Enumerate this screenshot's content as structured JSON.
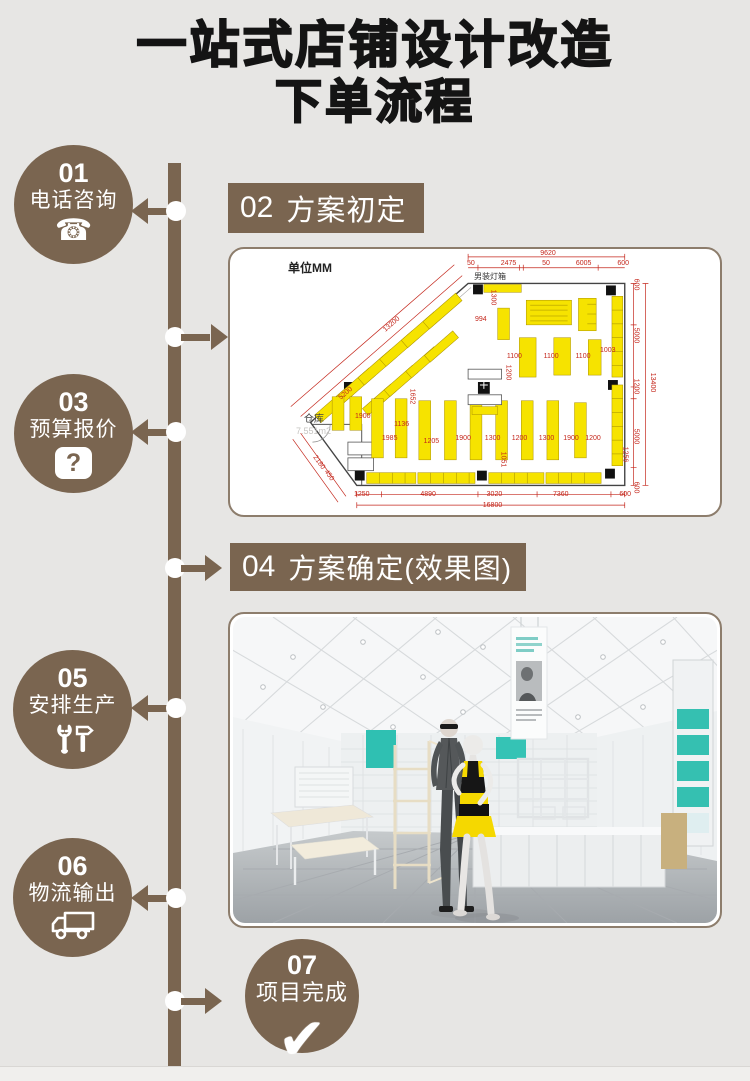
{
  "page": {
    "background": "#e7e6e4",
    "accent_brown": "#7a6550",
    "dim_red": "#c4271c",
    "shelf_yellow": "#f6e300",
    "teal": "#2fc0b2"
  },
  "title": {
    "line1": "一站式店铺设计改造",
    "line2": "下单流程"
  },
  "steps": {
    "s01": {
      "num": "01",
      "label": "电话咨询",
      "icon": "phone-icon",
      "icon_char": "☎"
    },
    "s02": {
      "num": "02",
      "label": "方案初定"
    },
    "s03": {
      "num": "03",
      "label": "预算报价",
      "icon": "question-icon",
      "icon_char": "?"
    },
    "s04": {
      "num": "04",
      "label": "方案确定(效果图)"
    },
    "s05": {
      "num": "05",
      "label": "安排生产",
      "icon": "tools-icon"
    },
    "s06": {
      "num": "06",
      "label": "物流输出",
      "icon": "truck-icon"
    },
    "s07": {
      "num": "07",
      "label": "项目完成",
      "icon": "check-icon",
      "icon_char": "✔"
    }
  },
  "floorplan": {
    "unit_label": "单位MM",
    "warehouse_label": "仓库",
    "warehouse_area": "7.551m2",
    "lightbox_label": "男装灯箱",
    "dims_top_total": "9620",
    "dims_top": [
      "50",
      "2475",
      "50",
      "6005",
      "600"
    ],
    "dims_right": [
      "600",
      "5000",
      "1200",
      "5000",
      "600"
    ],
    "dims_right_total": "13400",
    "dims_bottom": [
      "1250",
      "4890",
      "3020",
      "7360",
      "600"
    ],
    "dims_bottom_total": "16800",
    "dims_diag": [
      {
        "t": "13200",
        "x": 31,
        "y": 27,
        "r": -41
      },
      {
        "t": "5200",
        "x": 22,
        "y": 53,
        "r": -41
      },
      {
        "t": "2180",
        "x": 16.5,
        "y": 79,
        "r": 54
      },
      {
        "t": "450",
        "x": 19,
        "y": 84,
        "r": 54
      }
    ],
    "shelf_labels": [
      {
        "t": "1300",
        "x": 52,
        "y": 17,
        "r": 90
      },
      {
        "t": "994",
        "x": 50,
        "y": 25
      },
      {
        "t": "1100",
        "x": 56.5,
        "y": 39
      },
      {
        "t": "1100",
        "x": 64,
        "y": 39
      },
      {
        "t": "1100",
        "x": 70.5,
        "y": 39
      },
      {
        "t": "1003",
        "x": 75.5,
        "y": 37
      },
      {
        "t": "1200",
        "x": 55,
        "y": 45,
        "r": 90
      },
      {
        "t": "1652",
        "x": 35.5,
        "y": 54,
        "r": 90
      },
      {
        "t": "1900",
        "x": 25.5,
        "y": 61.5
      },
      {
        "t": "1136",
        "x": 33.5,
        "y": 64.5
      },
      {
        "t": "1985",
        "x": 31,
        "y": 70
      },
      {
        "t": "1205",
        "x": 39.5,
        "y": 71
      },
      {
        "t": "1900",
        "x": 46,
        "y": 70
      },
      {
        "t": "1300",
        "x": 52,
        "y": 70
      },
      {
        "t": "1200",
        "x": 57.5,
        "y": 70
      },
      {
        "t": "1300",
        "x": 63,
        "y": 70
      },
      {
        "t": "1900",
        "x": 68,
        "y": 70
      },
      {
        "t": "1200",
        "x": 72.5,
        "y": 70
      },
      {
        "t": "1051",
        "x": 54,
        "y": 78,
        "r": 90
      },
      {
        "t": "1256",
        "x": 79,
        "y": 76,
        "r": 90
      }
    ]
  }
}
